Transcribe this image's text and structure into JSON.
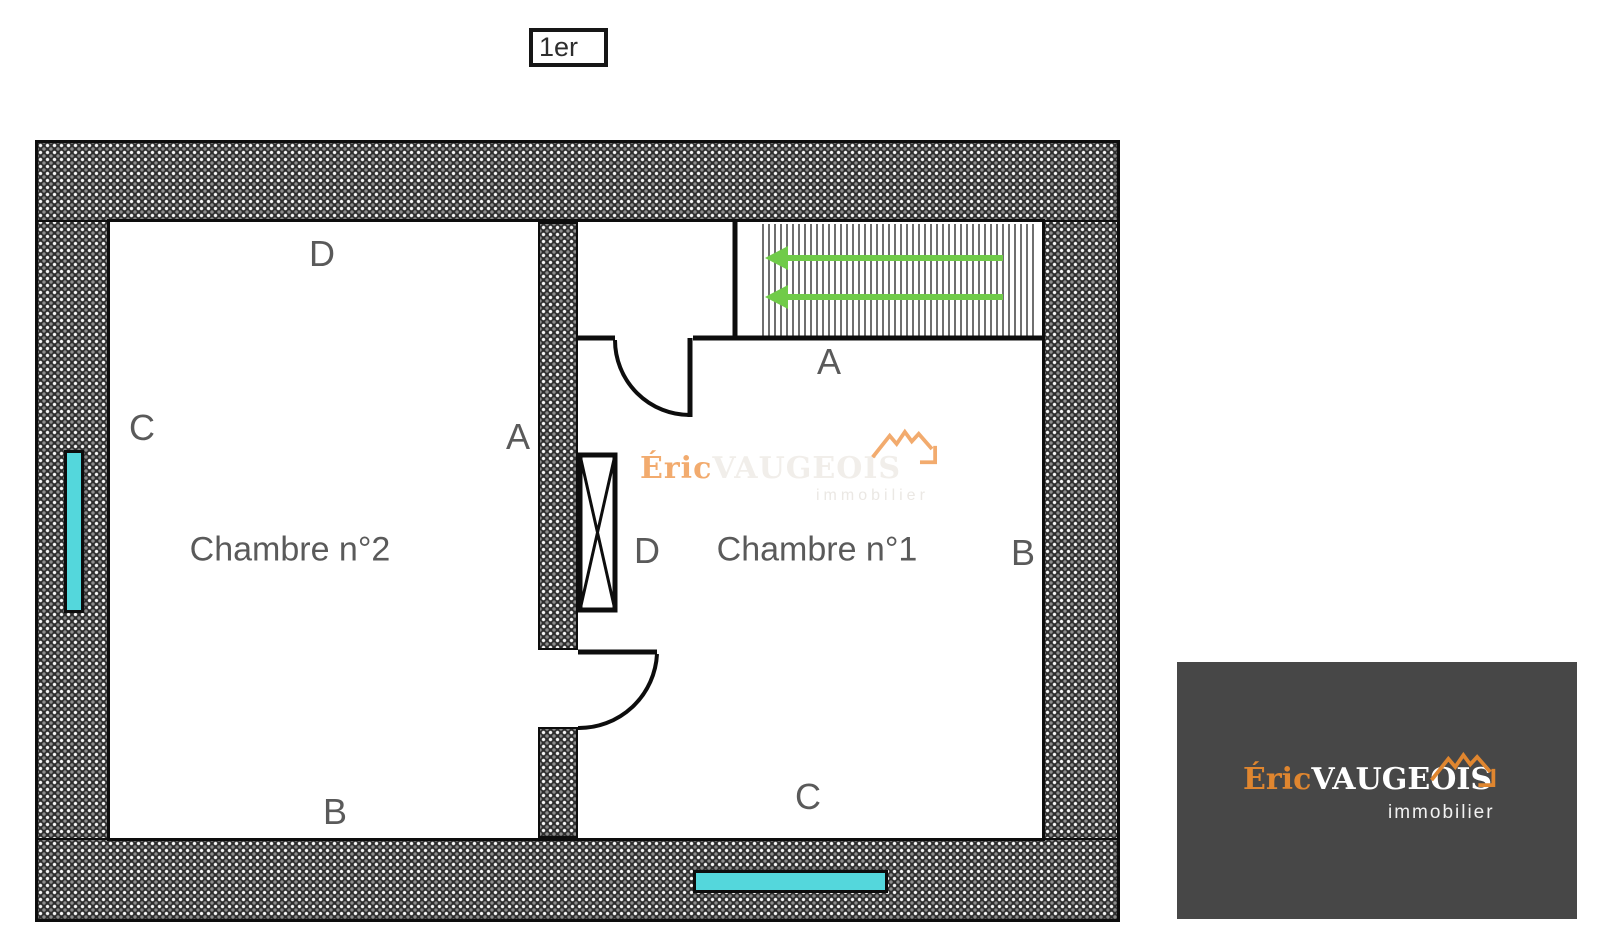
{
  "floor_badge": {
    "label": "1er"
  },
  "plan": {
    "room2": {
      "name": "Chambre n°2",
      "label_top": "D",
      "label_left": "C",
      "label_right": "A",
      "label_bottom": "B"
    },
    "room1": {
      "name": "Chambre n°1",
      "label_top": "A",
      "label_left": "D",
      "label_right": "B",
      "label_bottom": "C"
    }
  },
  "watermark": {
    "brand_first": "Éric",
    "brand_last": "VAUGEOIS",
    "tagline": "immobilier"
  },
  "logo_card": {
    "brand_first": "Éric",
    "brand_last": "VAUGEOIS",
    "tagline": "immobilier"
  },
  "colors": {
    "window-cyan": "#54d7dc",
    "arrow-green": "#70cb49",
    "brand-orange": "#e0862f",
    "watermark-orange": "#f2ab6e",
    "logo-bg": "#474747",
    "label-gray": "#5a5a5a"
  }
}
